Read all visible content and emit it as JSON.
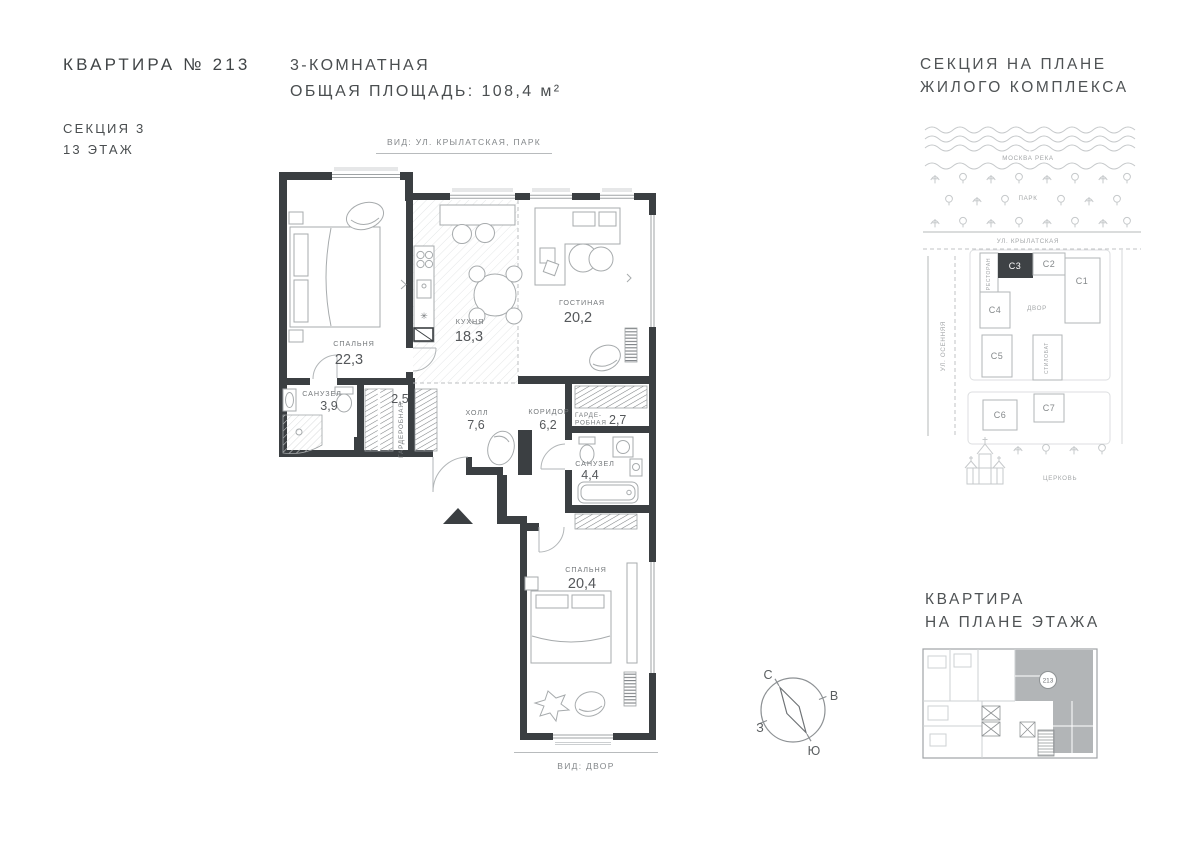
{
  "header": {
    "apartment": "КВАРТИРА № 213",
    "section": "СЕКЦИЯ 3",
    "floor": "13 ЭТАЖ",
    "rooms_count": "3-КОМНАТНАЯ",
    "total_area": "ОБЩАЯ ПЛОЩАДЬ: 108,4 м²"
  },
  "plan": {
    "view_top": "ВИД: УЛ. КРЫЛАТСКАЯ, ПАРК",
    "view_bottom": "ВИД: ДВОР",
    "rooms": {
      "bedroom1": {
        "name": "СПАЛЬНЯ",
        "area": "22,3"
      },
      "kitchen": {
        "name": "КУХНЯ",
        "area": "18,3"
      },
      "living": {
        "name": "ГОСТИНАЯ",
        "area": "20,2"
      },
      "bath1": {
        "name": "САНУЗЕЛ",
        "area": "3,9"
      },
      "wardrobe1": {
        "name": "ГАРДЕРОБНАЯ",
        "area": "2,5"
      },
      "hall": {
        "name": "ХОЛЛ",
        "area": "7,6"
      },
      "corridor": {
        "name": "КОРИДОР",
        "area": "6,2"
      },
      "wardrobe2": {
        "name_line1": "ГАРДЕ-",
        "name_line2": "РОБНАЯ",
        "area": "2,7"
      },
      "bath2": {
        "name": "САНУЗЕЛ",
        "area": "4,4"
      },
      "bedroom2": {
        "name": "СПАЛЬНЯ",
        "area": "20,4"
      }
    },
    "compass": {
      "n": "С",
      "e": "В",
      "s": "Ю",
      "w": "З"
    }
  },
  "site_map": {
    "title1": "СЕКЦИЯ НА ПЛАНЕ",
    "title2": "ЖИЛОГО КОМПЛЕКСА",
    "river": "МОСКВА РЕКА",
    "park": "ПАРК",
    "street_top": "УЛ. КРЫЛАТСКАЯ",
    "street_left": "УЛ. ОСЕННЯЯ",
    "restaurant": "РЕСТОРАН",
    "courtyard": "ДВОР",
    "stylobate": "СТИЛОБАТ",
    "church": "ЦЕРКОВЬ",
    "sections": {
      "c1": "C1",
      "c2": "C2",
      "c3": "C3",
      "c4": "C4",
      "c5": "C5",
      "c6": "C6",
      "c7": "C7"
    },
    "highlighted_section": "C3"
  },
  "floor_plan_mini": {
    "title1": "КВАРТИРА",
    "title2": "НА ПЛАНЕ ЭТАЖА",
    "apartment_number": "213"
  },
  "colors": {
    "wall": "#3b3f42",
    "text_dark": "#45494b",
    "text_gray": "#8b8f91",
    "line_light": "#c3c6c8",
    "section_highlight": "#3e4245",
    "mini_highlight": "#b2b5b7"
  }
}
